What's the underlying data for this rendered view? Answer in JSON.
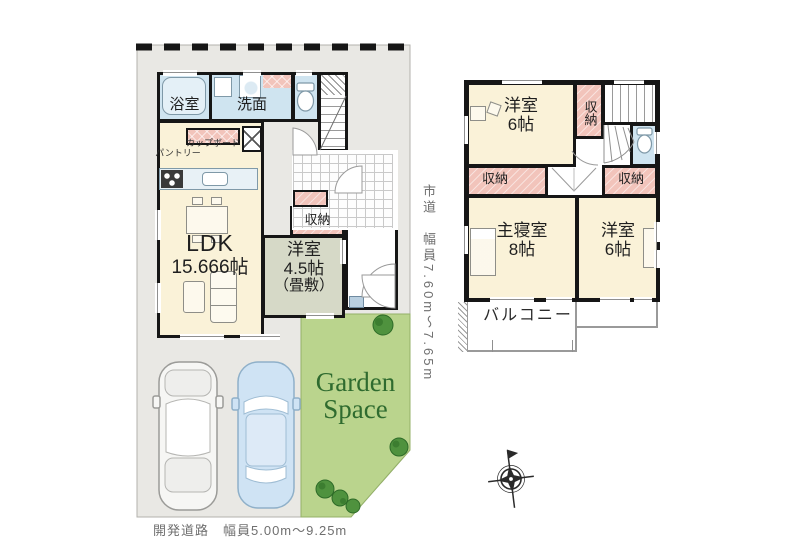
{
  "floor1": {
    "bath": "浴室",
    "washroom": "洗面",
    "cupboard": "カップボード",
    "pantry": "パントリー",
    "ldk_name": "LDK",
    "ldk_size": "15.666帖",
    "storage": "収納",
    "tatami_name": "洋室",
    "tatami_size": "4.5帖",
    "tatami_note": "（畳敷）",
    "garden_word1": "Garden",
    "garden_word2": "Space"
  },
  "floor2": {
    "bedroom1_name": "洋室",
    "bedroom1_size": "6帖",
    "closet_top": "収納",
    "closet_left": "収納",
    "closet_right": "収納",
    "master_name": "主寝室",
    "master_size": "8帖",
    "bedroom2_name": "洋室",
    "bedroom2_size": "6帖",
    "balcony": "バルコニー"
  },
  "roads": {
    "east": "市道　幅員7.60m〜7.65m",
    "south": "開発道路　幅員5.00m〜9.25m"
  },
  "colors": {
    "wall": "#161616",
    "room": "#faf2d8",
    "wet_area": "#cfe4f0",
    "closet": "#f2c4bb",
    "tatami": "#d6d9c7",
    "site": "#e9e8e4",
    "garden": "#bad48d",
    "garden_text": "#2f6b2f"
  }
}
